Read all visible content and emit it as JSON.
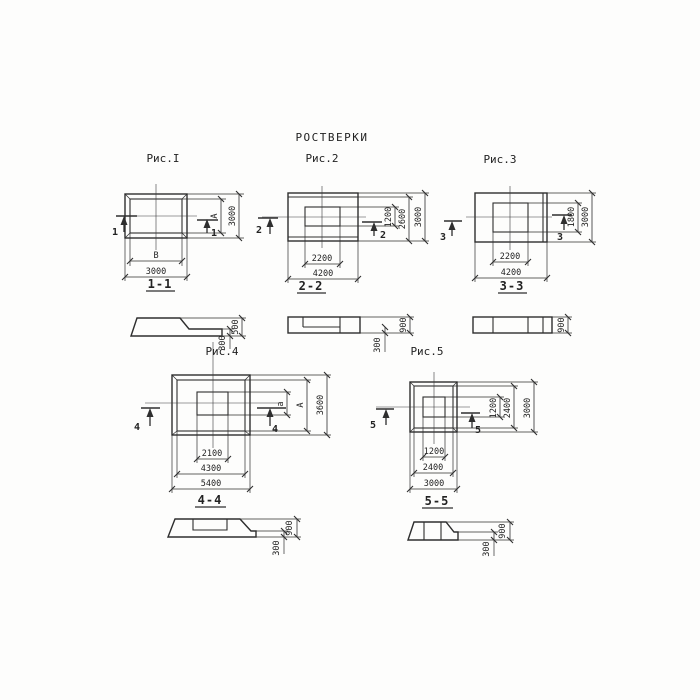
{
  "title": "РОСТВЕРКИ",
  "colors": {
    "line": "#2e2e2e",
    "background": "#fdfdfc"
  },
  "f1": {
    "label": "Рис.I",
    "mark": "1",
    "section_label": "1-1",
    "plan": {
      "dim_b": "В",
      "dim_w": "3000",
      "dim_a": "А",
      "dim_h": "3000"
    },
    "section": {
      "h_total": "500",
      "h_toe": "300"
    }
  },
  "f2": {
    "label": "Рис.2",
    "mark": "2",
    "section_label": "2-2",
    "plan": {
      "dim_inner_w": "2200",
      "dim_w": "4200",
      "dim_inner_h": "1200",
      "dim_mid_h": "2600",
      "dim_h": "3000"
    },
    "section": {
      "h_total": "900",
      "h_toe": "300"
    }
  },
  "f3": {
    "label": "Рис.3",
    "mark": "3",
    "section_label": "3-3",
    "plan": {
      "dim_inner_w": "2200",
      "dim_w": "4200",
      "dim_inner_h": "1800",
      "dim_h": "3000"
    },
    "section": {
      "h_total": "900"
    }
  },
  "f4": {
    "label": "Рис.4",
    "mark": "4",
    "section_label": "4-4",
    "plan": {
      "dim_inner_w": "2100",
      "dim_mid_w": "4300",
      "dim_w": "5400",
      "dim_a_small": "а",
      "dim_a_big": "А",
      "dim_h": "3600"
    },
    "section": {
      "h_total": "900",
      "h_toe": "300"
    }
  },
  "f5": {
    "label": "Рис.5",
    "mark": "5",
    "section_label": "5-5",
    "plan": {
      "dim_inner_w": "1200",
      "dim_mid_w": "2400",
      "dim_w": "3000",
      "dim_inner_h": "1200",
      "dim_mid_h": "2400",
      "dim_h": "3000"
    },
    "section": {
      "h_total": "900",
      "h_toe": "300"
    }
  }
}
